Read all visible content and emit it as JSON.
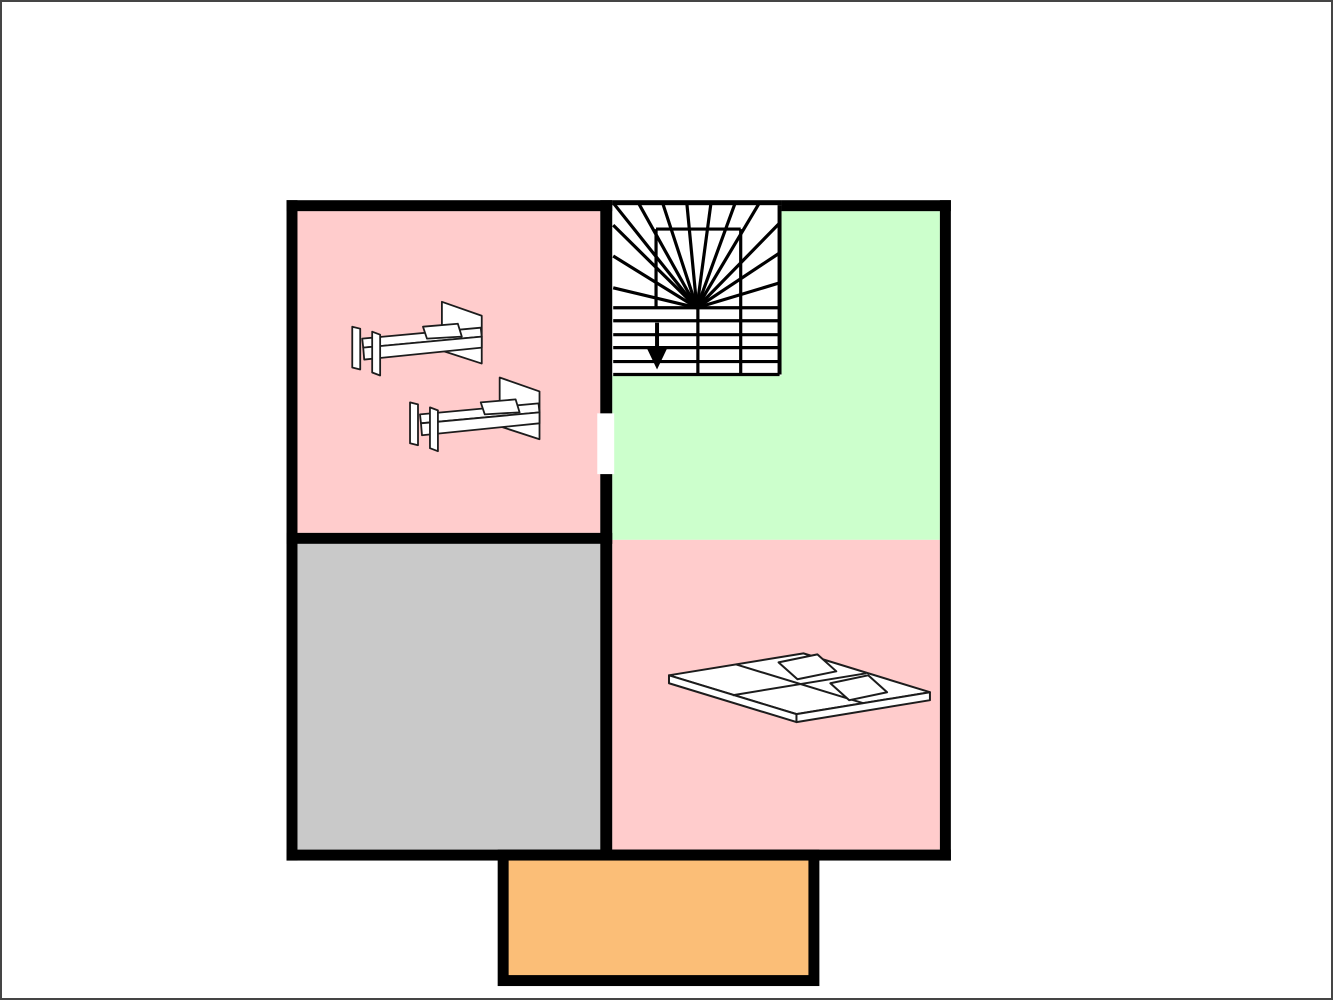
{
  "canvas": {
    "width": 1333,
    "height": 1000,
    "background": "#ffffff",
    "frame_color": "#454545"
  },
  "palette": {
    "wall": "#000000",
    "room_pink": "#FFCCCC",
    "room_green": "#CCFFCC",
    "room_gray": "#C9C9C9",
    "balcony_orange": "#FBBE77",
    "floor_white": "#FFFFFF",
    "furniture_fill": "#FFFFFF",
    "furniture_stroke": "#1C1C1C"
  },
  "rooms": [
    {
      "name": "bedroom-top-left",
      "fill": "room_pink",
      "rect": [
        296,
        210,
        304,
        323
      ]
    },
    {
      "name": "landing-top-right",
      "fill": "room_green",
      "rect": [
        612,
        210,
        329,
        330
      ]
    },
    {
      "name": "room-bottom-left",
      "fill": "room_gray",
      "rect": [
        296,
        544,
        304,
        307
      ]
    },
    {
      "name": "bedroom-bottom-right",
      "fill": "room_pink",
      "rect": [
        612,
        540,
        329,
        311
      ]
    }
  ],
  "walls": [
    {
      "name": "wall-top-left-segment",
      "rect": [
        285,
        199,
        327,
        11
      ]
    },
    {
      "name": "wall-top-stair-thin",
      "rect": [
        612,
        199,
        170,
        5
      ]
    },
    {
      "name": "wall-top-right-segment",
      "rect": [
        782,
        199,
        170,
        11
      ]
    },
    {
      "name": "wall-left",
      "rect": [
        285,
        199,
        11,
        663
      ]
    },
    {
      "name": "wall-right",
      "rect": [
        941,
        199,
        11,
        663
      ]
    },
    {
      "name": "wall-bottom",
      "rect": [
        285,
        851,
        667,
        11
      ]
    },
    {
      "name": "wall-center-vertical",
      "rect": [
        600,
        199,
        12,
        663
      ]
    },
    {
      "name": "wall-middle-horizontal",
      "rect": [
        285,
        533,
        327,
        11
      ]
    }
  ],
  "door_opening": {
    "rect": [
      597,
      413,
      17,
      61
    ]
  },
  "stairs": {
    "area": [
      612,
      204,
      170,
      171
    ],
    "line_width": 3.2,
    "fan_center": [
      697,
      307
    ],
    "fan_endpoints": [
      [
        613,
        224
      ],
      [
        613,
        255
      ],
      [
        613,
        287
      ],
      [
        614,
        203
      ],
      [
        639,
        203
      ],
      [
        663,
        203
      ],
      [
        687,
        203
      ],
      [
        711,
        203
      ],
      [
        735,
        203
      ],
      [
        759,
        203
      ],
      [
        780,
        222
      ],
      [
        780,
        252
      ],
      [
        780,
        282
      ]
    ],
    "tread_span": [
      613,
      780
    ],
    "tread_ys": [
      307,
      320,
      334,
      347,
      361,
      374
    ],
    "verticals": [
      {
        "x": 780,
        "y1": 204,
        "y2": 374,
        "w": 4
      },
      {
        "x": 698,
        "y1": 307,
        "y2": 374,
        "w": 3.2
      },
      {
        "x": 741,
        "y1": 228,
        "y2": 374,
        "w": 3.2
      },
      {
        "x": 656,
        "y1": 228,
        "y2": 307,
        "w": 3.2
      }
    ],
    "inner_box_top": {
      "y": 228,
      "x1": 656,
      "x2": 741
    },
    "arrow": {
      "stem": [
        657,
        322,
        657,
        350
      ],
      "stem_width": 4,
      "head": [
        [
          647,
          348
        ],
        [
          667,
          348
        ],
        [
          657,
          369
        ]
      ]
    }
  },
  "single_bed": {
    "stroke_width": 1.8,
    "instances": [
      [
        350,
        300
      ],
      [
        408,
        376
      ]
    ],
    "parts": [
      {
        "name": "headboard",
        "points": [
          [
            91,
            1
          ],
          [
            131,
            15
          ],
          [
            131,
            63
          ],
          [
            91,
            50
          ]
        ]
      },
      {
        "name": "platform-top",
        "points": [
          [
            11,
            38
          ],
          [
            130,
            27
          ],
          [
            131,
            36
          ],
          [
            12,
            47
          ]
        ]
      },
      {
        "name": "platform-front",
        "points": [
          [
            12,
            47
          ],
          [
            131,
            36
          ],
          [
            131,
            47
          ],
          [
            13,
            59
          ]
        ]
      },
      {
        "name": "pillow",
        "points": [
          [
            72,
            26
          ],
          [
            107,
            23
          ],
          [
            111,
            36
          ],
          [
            76,
            38
          ]
        ]
      },
      {
        "name": "foot-slat-outer",
        "points": [
          [
            1,
            26
          ],
          [
            9,
            28
          ],
          [
            9,
            69
          ],
          [
            1,
            67
          ]
        ]
      },
      {
        "name": "foot-slat-inner",
        "points": [
          [
            21,
            31
          ],
          [
            29,
            34
          ],
          [
            29,
            75
          ],
          [
            21,
            72
          ]
        ]
      }
    ]
  },
  "double_bed": {
    "stroke_width": 2,
    "parts": [
      {
        "name": "mattress-top",
        "points": [
          [
            669,
            676
          ],
          [
            804,
            654
          ],
          [
            931,
            693
          ],
          [
            797,
            715
          ]
        ]
      },
      {
        "name": "side-face-left",
        "points": [
          [
            669,
            676
          ],
          [
            797,
            715
          ],
          [
            797,
            723
          ],
          [
            669,
            684
          ]
        ]
      },
      {
        "name": "side-face-right",
        "points": [
          [
            797,
            715
          ],
          [
            931,
            693
          ],
          [
            931,
            701
          ],
          [
            797,
            723
          ]
        ]
      }
    ],
    "seams": [
      {
        "name": "mattress-seam-cross",
        "line": [
          736,
          665,
          864,
          704
        ]
      },
      {
        "name": "mattress-seam-long",
        "line": [
          733,
          696,
          867,
          674
        ]
      }
    ],
    "pillows": [
      {
        "name": "pillow-left",
        "points": [
          [
            779,
            663
          ],
          [
            818,
            655
          ],
          [
            837,
            672
          ],
          [
            798,
            680
          ]
        ]
      },
      {
        "name": "pillow-right",
        "points": [
          [
            831,
            684
          ],
          [
            869,
            676
          ],
          [
            888,
            693
          ],
          [
            850,
            701
          ]
        ]
      }
    ]
  },
  "balcony": {
    "outer_rect": [
      497,
      851,
      323,
      137
    ],
    "inner_rect": [
      508,
      862,
      301,
      115
    ]
  }
}
